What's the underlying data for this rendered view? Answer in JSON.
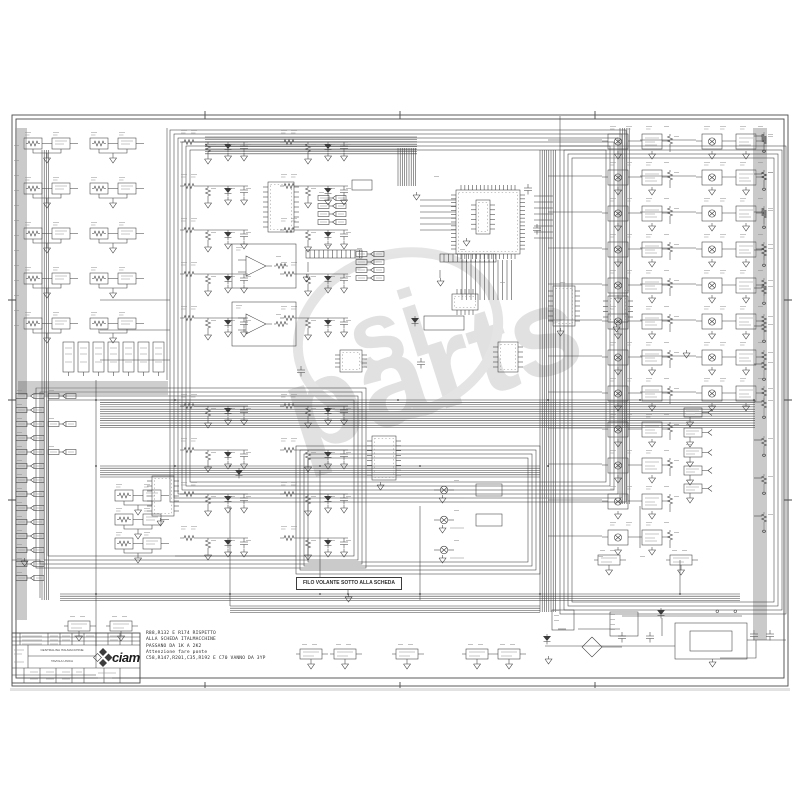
{
  "page": {
    "ink": "#3c3c3c",
    "watermark_color": "#c9c9c9",
    "shadow": "#e2e2e2"
  },
  "watermark": {
    "prefix": "si",
    "word": "parts"
  },
  "labels": {
    "filo_volante": "FILO VOLANTE SOTTO ALLA SCHEDA"
  },
  "notes": {
    "lines": [
      "R88,R132 E R174 RISPETTO",
      "ALLA SCHEDA ITALMACCHINE",
      "PASSANO DA 1K A 2K2",
      "Attenzione    fare ponte",
      "C58,R147,R201,C35,R192 E C70 VANNO DA 3YP"
    ]
  },
  "title_block": {
    "logo": "ciam",
    "title_line1": "CENTRALINA ITALMACCHINE",
    "title_line2": "TAVOLA UNICA"
  },
  "schematic": {
    "buses": [
      {
        "x": 205,
        "y": 137,
        "len": 212,
        "n": 8,
        "gap": 2.4,
        "dir": "h"
      },
      {
        "x": 100,
        "y": 400,
        "len": 655,
        "n": 13,
        "gap": 2.3,
        "dir": "h"
      },
      {
        "x": 16,
        "y": 128,
        "len": 492,
        "n": 6,
        "gap": 2.0,
        "dir": "v"
      },
      {
        "x": 42,
        "y": 150,
        "len": 450,
        "n": 4,
        "gap": 2.2,
        "dir": "v"
      },
      {
        "x": 398,
        "y": 148,
        "len": 38,
        "n": 9,
        "gap": 2.2,
        "dir": "v"
      },
      {
        "x": 540,
        "y": 150,
        "len": 462,
        "n": 8,
        "gap": 2.2,
        "dir": "v"
      },
      {
        "x": 754,
        "y": 128,
        "len": 512,
        "n": 7,
        "gap": 2.0,
        "dir": "v"
      },
      {
        "x": 60,
        "y": 594,
        "len": 680,
        "n": 4,
        "gap": 2.2,
        "dir": "h"
      },
      {
        "x": 230,
        "y": 606,
        "len": 310,
        "n": 4,
        "gap": 2.2,
        "dir": "h"
      },
      {
        "x": 100,
        "y": 466,
        "len": 440,
        "n": 6,
        "gap": 2.2,
        "dir": "h"
      },
      {
        "x": 18,
        "y": 382,
        "len": 150,
        "n": 7,
        "gap": 2.0,
        "dir": "h"
      },
      {
        "x": 620,
        "y": 128,
        "len": 376,
        "n": 5,
        "gap": 2.3,
        "dir": "v"
      }
    ],
    "rings": [
      {
        "x": 170,
        "y": 130,
        "w": 456,
        "h": 372,
        "n": 6,
        "inset": 4
      },
      {
        "x": 560,
        "y": 146,
        "w": 226,
        "h": 468,
        "n": 4,
        "inset": 4
      },
      {
        "x": 296,
        "y": 446,
        "w": 244,
        "h": 128,
        "n": 4,
        "inset": 4
      },
      {
        "x": 36,
        "y": 388,
        "w": 330,
        "h": 180,
        "n": 4,
        "inset": 4
      }
    ],
    "fans": [
      {
        "x1": 548,
        "x2": 602,
        "y0": 140,
        "dy": 36,
        "n": 12
      },
      {
        "x1": 640,
        "x2": 696,
        "y0": 140,
        "dy": 36,
        "n": 8
      },
      {
        "x1": 534,
        "x2": 553,
        "y0": 196,
        "dy": 6,
        "n": 8
      },
      {
        "x1": 420,
        "x2": 456,
        "y0": 200,
        "dy": 6,
        "n": 6
      },
      {
        "x1": 754,
        "x2": 762,
        "y0": 136,
        "dy": 38,
        "n": 11
      },
      {
        "x0": 462,
        "dx": 4.5,
        "n": 12,
        "y1": 260,
        "y2": 300,
        "vert": true
      }
    ],
    "ics": [
      {
        "x": 456,
        "y": 190,
        "w": 64,
        "h": 64,
        "pt": 15,
        "ps": 15
      },
      {
        "x": 268,
        "y": 182,
        "w": 26,
        "h": 50,
        "pt": 0,
        "ps": 9
      },
      {
        "x": 372,
        "y": 436,
        "w": 24,
        "h": 44,
        "pt": 0,
        "ps": 8
      },
      {
        "x": 152,
        "y": 476,
        "w": 22,
        "h": 40,
        "pt": 0,
        "ps": 7
      },
      {
        "x": 553,
        "y": 286,
        "w": 22,
        "h": 40,
        "pt": 0,
        "ps": 7
      },
      {
        "x": 498,
        "y": 342,
        "w": 20,
        "h": 30,
        "pt": 0,
        "ps": 5
      },
      {
        "x": 340,
        "y": 350,
        "w": 22,
        "h": 22,
        "pt": 0,
        "ps": 4
      },
      {
        "x": 452,
        "y": 294,
        "w": 26,
        "h": 16,
        "pt": 5,
        "ps": 0
      },
      {
        "x": 608,
        "y": 296,
        "w": 20,
        "h": 26,
        "pt": 0,
        "ps": 4
      },
      {
        "x": 476,
        "y": 200,
        "w": 14,
        "h": 34,
        "pt": 0,
        "ps": 6
      }
    ],
    "uses": [
      {
        "sym": "filter-cell",
        "pts": [
          [
            180,
            128
          ],
          [
            280,
            128
          ],
          [
            180,
            172
          ],
          [
            280,
            172
          ],
          [
            180,
            216
          ],
          [
            280,
            216
          ],
          [
            180,
            260
          ],
          [
            280,
            260
          ],
          [
            180,
            304
          ],
          [
            280,
            304
          ],
          [
            180,
            392
          ],
          [
            280,
            392
          ],
          [
            180,
            436
          ],
          [
            280,
            436
          ],
          [
            180,
            480
          ],
          [
            280,
            480
          ],
          [
            180,
            524
          ],
          [
            280,
            524
          ]
        ]
      },
      {
        "sym": "opto-in",
        "pts": [
          [
            22,
            132
          ],
          [
            88,
            132
          ],
          [
            22,
            177
          ],
          [
            88,
            177
          ],
          [
            22,
            222
          ],
          [
            88,
            222
          ],
          [
            22,
            267
          ],
          [
            88,
            267
          ],
          [
            22,
            312
          ],
          [
            88,
            312
          ],
          [
            113,
            484
          ],
          [
            113,
            508
          ],
          [
            113,
            532
          ]
        ]
      },
      {
        "sym": "netflag",
        "pts": [
          [
            16,
            390
          ],
          [
            16,
            404
          ],
          [
            16,
            418
          ],
          [
            16,
            432
          ],
          [
            16,
            446
          ],
          [
            16,
            460
          ],
          [
            16,
            474
          ],
          [
            16,
            488
          ],
          [
            16,
            502
          ],
          [
            16,
            516
          ],
          [
            16,
            530
          ],
          [
            16,
            544
          ],
          [
            16,
            558
          ],
          [
            16,
            572
          ],
          [
            48,
            390
          ],
          [
            48,
            418
          ],
          [
            48,
            446
          ],
          [
            318,
            192
          ],
          [
            318,
            200
          ],
          [
            318,
            208
          ],
          [
            318,
            216
          ],
          [
            356,
            248
          ],
          [
            356,
            256
          ],
          [
            356,
            264
          ],
          [
            356,
            272
          ]
        ]
      },
      {
        "sym": "driver",
        "pts": [
          [
            602,
            126
          ],
          [
            602,
            162
          ],
          [
            602,
            198
          ],
          [
            602,
            234
          ],
          [
            602,
            270
          ],
          [
            602,
            306
          ],
          [
            602,
            342
          ],
          [
            602,
            378
          ],
          [
            602,
            414
          ],
          [
            602,
            450
          ],
          [
            602,
            486
          ],
          [
            602,
            522
          ],
          [
            696,
            126
          ],
          [
            696,
            162
          ],
          [
            696,
            198
          ],
          [
            696,
            234
          ],
          [
            696,
            270
          ],
          [
            696,
            306
          ],
          [
            696,
            342
          ],
          [
            696,
            378
          ]
        ]
      },
      {
        "sym": "smalldrv",
        "pts": [
          [
            684,
            404
          ],
          [
            684,
            424
          ],
          [
            684,
            444
          ],
          [
            684,
            462
          ],
          [
            684,
            480
          ]
        ]
      },
      {
        "sym": "relayout",
        "pts": [
          [
            434,
            480
          ],
          [
            434,
            510
          ],
          [
            434,
            540
          ]
        ]
      },
      {
        "sym": "regblk",
        "pts": [
          [
            296,
            644
          ],
          [
            330,
            644
          ],
          [
            392,
            644
          ],
          [
            462,
            644
          ],
          [
            494,
            644
          ],
          [
            64,
            616
          ],
          [
            106,
            616
          ],
          [
            594,
            550
          ],
          [
            666,
            550
          ]
        ]
      },
      {
        "sym": "resterm",
        "pts": [
          [
            760,
            130
          ],
          [
            760,
            168
          ],
          [
            760,
            206
          ],
          [
            760,
            244
          ],
          [
            760,
            282
          ],
          [
            760,
            320
          ],
          [
            760,
            358
          ],
          [
            760,
            396
          ],
          [
            760,
            434
          ],
          [
            760,
            472
          ],
          [
            760,
            510
          ]
        ]
      },
      {
        "sym": "relayrectv",
        "pts": [
          [
            62,
            342
          ],
          [
            77,
            342
          ],
          [
            92,
            342
          ],
          [
            107,
            342
          ],
          [
            122,
            342
          ],
          [
            137,
            342
          ],
          [
            152,
            342
          ]
        ]
      },
      {
        "sym": "hdr12",
        "pts": [
          [
            440,
            254
          ],
          [
            306,
            250
          ]
        ]
      },
      {
        "sym": "opampbox",
        "pts": [
          [
            232,
            244
          ],
          [
            232,
            302
          ]
        ]
      }
    ],
    "rects": [
      [
        675,
        623,
        72,
        36
      ],
      [
        690,
        631,
        42,
        20
      ],
      [
        610,
        612,
        28,
        24
      ],
      [
        552,
        610,
        22,
        20
      ],
      [
        352,
        180,
        20,
        10
      ],
      [
        424,
        316,
        40,
        14
      ],
      [
        476,
        484,
        26,
        12
      ],
      [
        476,
        514,
        26,
        12
      ]
    ],
    "polys": [
      "96,380 96,646",
      "230,506 230,606",
      "320,470 320,577",
      "420,506 420,600",
      "560,116 560,146",
      "348,588 348,594",
      "680,560 680,594",
      "12,560 40,560 40,598",
      "545,646 675,646",
      "747,640 786,640",
      "578,629 620,629",
      "558,629 566,629",
      "592,637 602,647 592,657 582,647 592,637",
      "602,647 622,647",
      "640,506 640,548",
      "175,556 296,556",
      "100,300 170,300",
      "100,330 170,330",
      "100,360 170,360",
      "756,640 756,658 720,658",
      "662,618 662,636",
      "440,270 440,278",
      "308,262 308,272",
      "167,128 167,380",
      "622,616 742,616"
    ],
    "dots": [
      [
        96,
        400
      ],
      [
        96,
        466
      ],
      [
        230,
        466
      ],
      [
        320,
        466
      ],
      [
        398,
        400
      ],
      [
        420,
        466
      ],
      [
        548,
        400
      ],
      [
        548,
        466
      ],
      [
        640,
        400
      ],
      [
        680,
        594
      ],
      [
        754,
        400
      ],
      [
        96,
        594
      ],
      [
        230,
        594
      ],
      [
        320,
        594
      ],
      [
        420,
        594
      ],
      [
        540,
        594
      ],
      [
        348,
        594
      ],
      [
        175,
        400
      ],
      [
        175,
        466
      ]
    ],
    "prims": {
      "gnd": [
        [
          437,
          278
        ],
        [
          303,
          274
        ],
        [
          545,
          656
        ],
        [
          709,
          659
        ],
        [
          21,
          558
        ],
        [
          413,
          192
        ],
        [
          463,
          238
        ],
        [
          377,
          482
        ],
        [
          157,
          518
        ],
        [
          557,
          328
        ],
        [
          613,
          324
        ],
        [
          683,
          350
        ],
        [
          345,
          594
        ]
      ],
      "capv": [
        [
          618,
          632
        ],
        [
          646,
          632
        ],
        [
          750,
          630
        ],
        [
          766,
          630
        ],
        [
          524,
          184
        ],
        [
          533,
          224
        ],
        [
          417,
          358
        ],
        [
          297,
          366
        ]
      ],
      "dio": [
        [
          543,
          634
        ],
        [
          657,
          608
        ],
        [
          411,
          316
        ],
        [
          235,
          468
        ]
      ],
      "resv": [
        [
          574,
          618
        ],
        [
          415,
          338
        ],
        [
          633,
          468
        ],
        [
          153,
          438
        ]
      ],
      "resh": [
        [
          560,
          624
        ],
        [
          296,
          254
        ]
      ],
      "term": [
        [
          716,
          610
        ],
        [
          734,
          610
        ]
      ],
      "txt1": [
        [
          14,
          145
        ],
        [
          14,
          160
        ],
        [
          14,
          175
        ],
        [
          14,
          190
        ],
        [
          14,
          205
        ],
        [
          14,
          220
        ],
        [
          14,
          235
        ],
        [
          14,
          250
        ],
        [
          14,
          265
        ],
        [
          14,
          280
        ],
        [
          14,
          295
        ],
        [
          14,
          310
        ],
        [
          14,
          325
        ],
        [
          554,
          610
        ],
        [
          554,
          615
        ],
        [
          554,
          620
        ],
        [
          610,
          614
        ],
        [
          610,
          619
        ],
        [
          610,
          624
        ],
        [
          610,
          629
        ],
        [
          598,
          556
        ],
        [
          640,
          556
        ],
        [
          434,
          176
        ],
        [
          500,
          282
        ],
        [
          560,
          282
        ],
        [
          624,
          290
        ]
      ]
    }
  }
}
